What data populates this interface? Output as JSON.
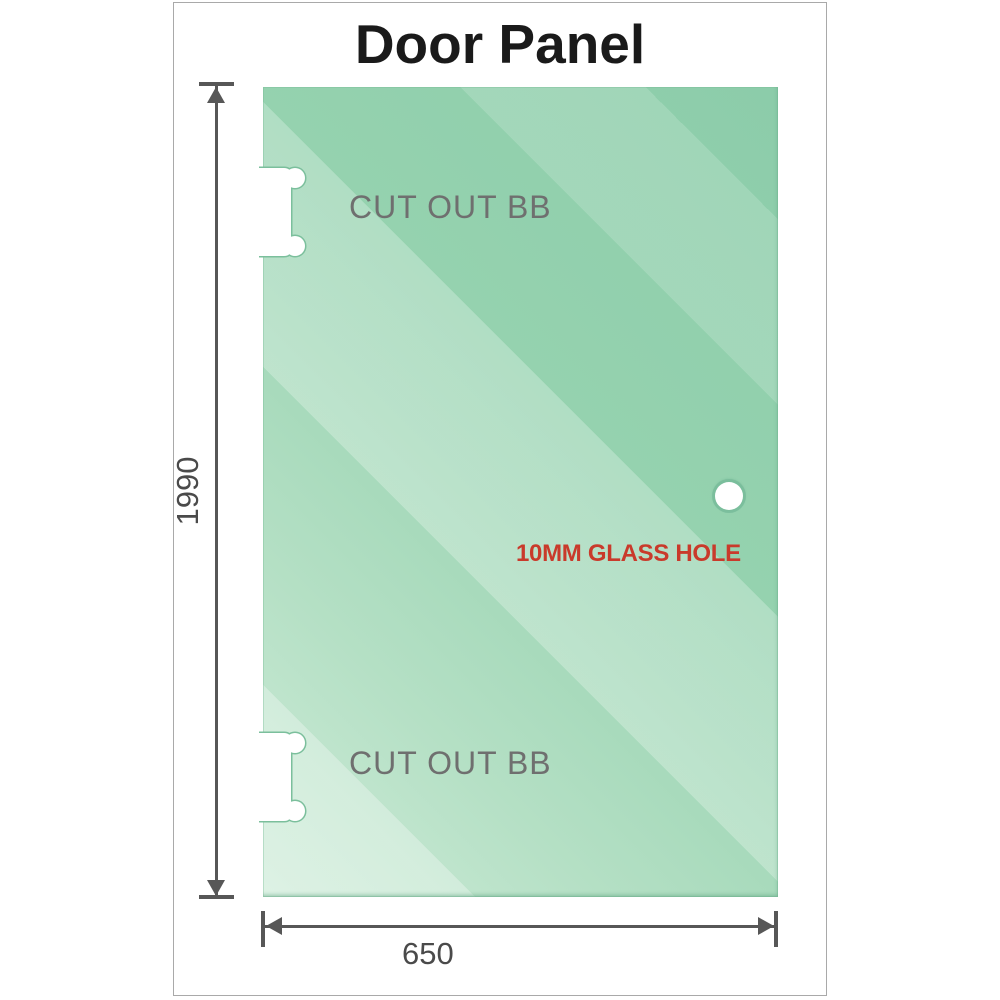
{
  "title": "Door Panel",
  "panel": {
    "cutout_top_label": "CUT OUT BB",
    "cutout_bottom_label": "CUT OUT BB",
    "glass_hole_label": "10MM GLASS HOLE"
  },
  "dimensions": {
    "height_mm": "1990",
    "width_mm": "650"
  },
  "colors": {
    "glass_base": "#95d2af",
    "glass_light": "#cfecd9",
    "dimension_line": "#575757",
    "cutout_label": "#6f6f6f",
    "hole_label_red": "#c93a2b",
    "frame_border": "#a9a9a9",
    "title_text": "#1a1a1a"
  }
}
